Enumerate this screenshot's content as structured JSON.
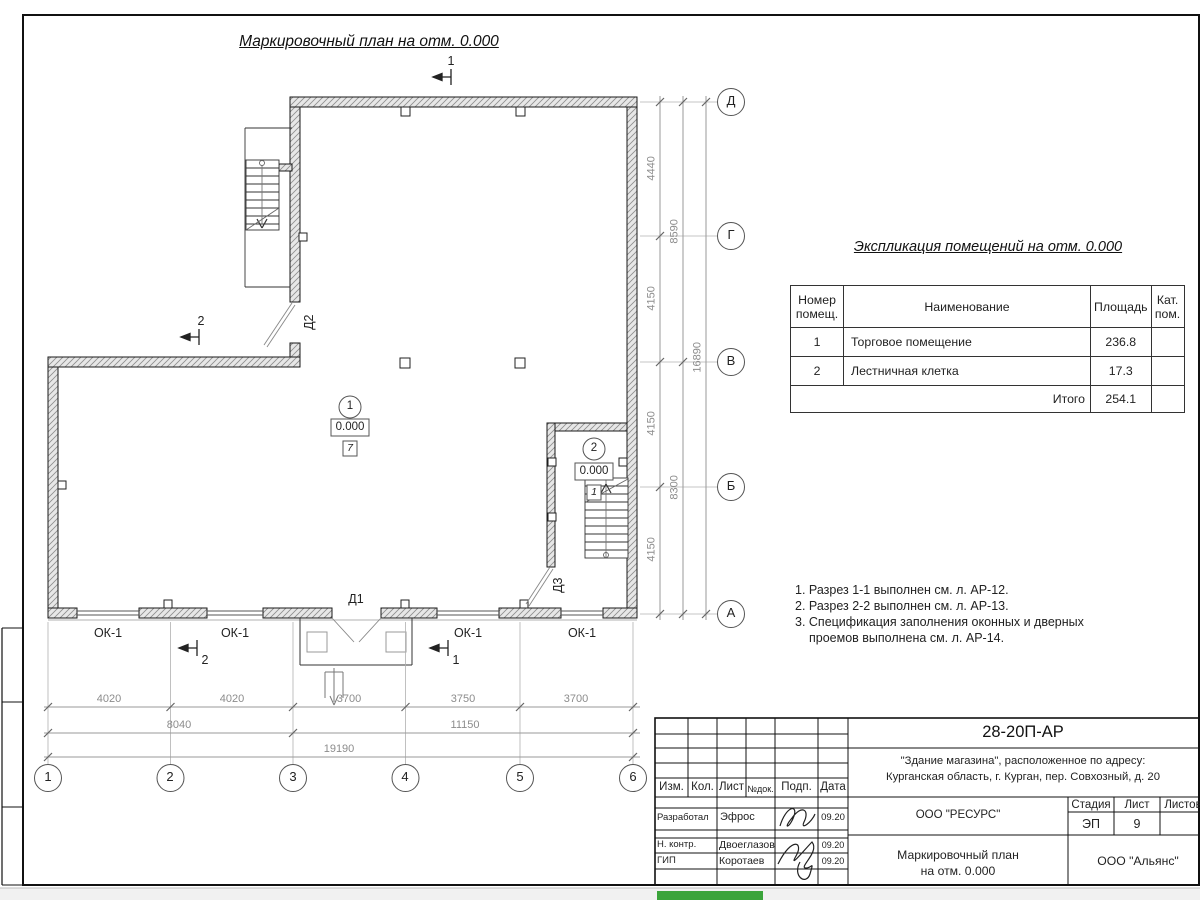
{
  "title": "Маркировочный план на отм. 0.000",
  "axes": {
    "cols": [
      "1",
      "2",
      "3",
      "4",
      "5",
      "6"
    ],
    "rows": [
      "Д",
      "Г",
      "В",
      "Б",
      "А"
    ]
  },
  "dims": {
    "b1": [
      "4020",
      "4020",
      "3700",
      "3750",
      "3700"
    ],
    "b2": [
      "8040",
      "11150"
    ],
    "b3": [
      "19190"
    ],
    "r1": [
      "4440",
      "4150",
      "4150",
      "4150"
    ],
    "r2": [
      "8590",
      "8300"
    ],
    "r3": [
      "16890"
    ]
  },
  "plan": {
    "windows": [
      "ОК-1",
      "ОК-1",
      "ОК-1",
      "ОК-1"
    ],
    "doors": {
      "d1": "Д1",
      "d2": "Д2",
      "d3": "Д3"
    },
    "rooms": [
      {
        "number": "1",
        "elevation": "0.000",
        "floor_type": "7"
      },
      {
        "number": "2",
        "elevation": "0.000",
        "floor_type": "1"
      }
    ],
    "sections": {
      "top": "1",
      "left": "2",
      "bottom_left": "2",
      "bottom_right": "1"
    }
  },
  "expl": {
    "title": "Экспликация помещений на отм. 0.000",
    "headers": [
      "Номер помещ.",
      "Наименование",
      "Площадь",
      "Кат. пом."
    ],
    "rows": [
      [
        "1",
        "Торговое помещение",
        "236.8",
        ""
      ],
      [
        "2",
        "Лестничная клетка",
        "17.3",
        ""
      ]
    ],
    "total_label": "Итого",
    "total_value": "254.1"
  },
  "notes": [
    "1. Разрез 1-1 выполнен см. л. АР-12.",
    "2. Разрез 2-2 выполнен см. л. АР-13.",
    "3. Спецификация заполнения оконных и дверных",
    "проемов выполнена см. л. АР-14."
  ],
  "tb": {
    "doc_number": "28-20П-АР",
    "object_line1": "\"Здание магазина\", расположенное по адресу:",
    "object_line2": "Курганская область, г. Курган, пер. Совхозный, д. 20",
    "designer_org": "ООО \"РЕСУРС\"",
    "sheet_title_line1": "Маркировочный план",
    "sheet_title_line2": "на отм. 0.000",
    "client_org": "ООО \"Альянс\"",
    "stage_label": "Стадия",
    "stage": "ЭП",
    "sheet_label": "Лист",
    "sheet": "9",
    "sheets_label": "Листов",
    "cols": [
      "Изм.",
      "Кол.",
      "Лист",
      "№док.",
      "Подп.",
      "Дата"
    ],
    "rows": [
      {
        "role": "Разработал",
        "name": "Эфрос",
        "date": "09.20"
      },
      {
        "role": "Н. контр.",
        "name": "Двоеглазов",
        "date": "09.20"
      },
      {
        "role": "ГИП",
        "name": "Коротаев",
        "date": "09.20"
      }
    ]
  },
  "colors": {
    "taskbar_green": "#3ba43b",
    "line_dark": "#1a1a1a",
    "line_dim": "#999999"
  }
}
